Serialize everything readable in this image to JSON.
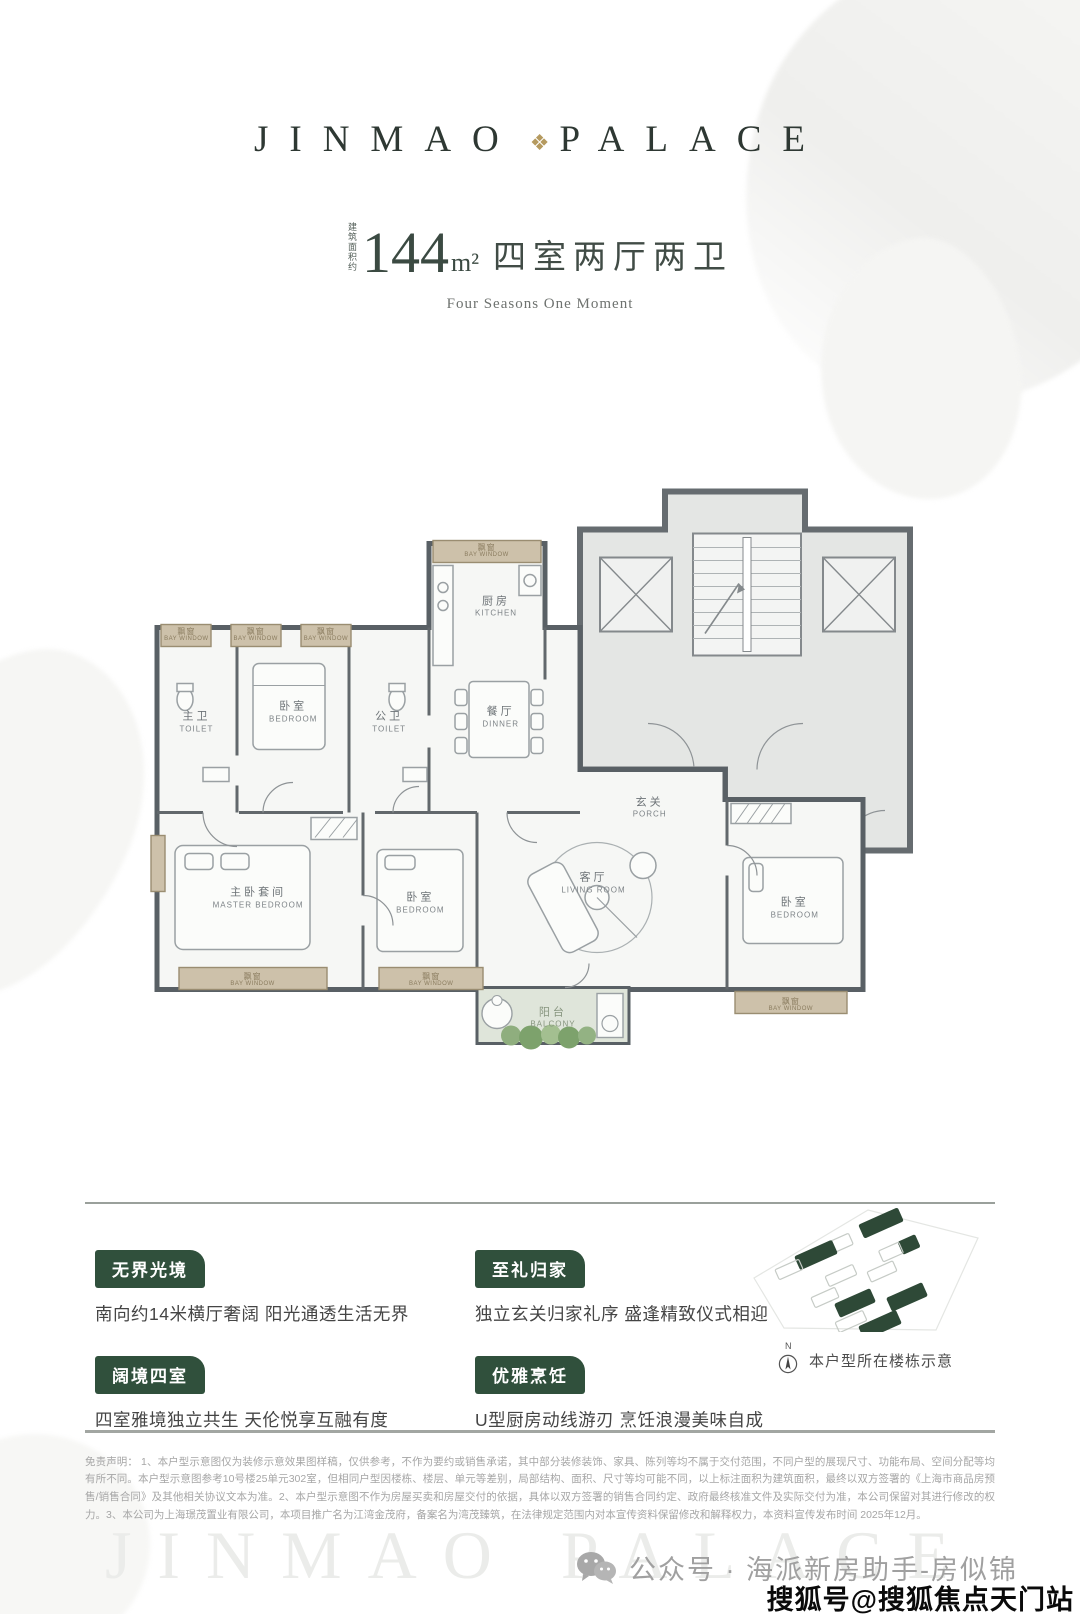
{
  "header": {
    "brand_left": "JINMAO",
    "brand_right": "PALACE",
    "emblem_glyph": "❖"
  },
  "title": {
    "area_prefix": "建筑面积约",
    "area_value": "144",
    "area_unit": "m²",
    "layout": "四室两厅两卫",
    "subtitle": "Four Seasons One Moment"
  },
  "floor_plan": {
    "rooms": [
      {
        "cn": "飘窗",
        "en": "BAY WINDOW",
        "x": 5.3,
        "y": 28.7,
        "style": "bay"
      },
      {
        "cn": "飘窗",
        "en": "BAY WINDOW",
        "x": 14.2,
        "y": 28.7,
        "style": "bay"
      },
      {
        "cn": "飘窗",
        "en": "BAY WINDOW",
        "x": 23.2,
        "y": 28.7,
        "style": "bay"
      },
      {
        "cn": "飘窗",
        "en": "BAY WINDOW",
        "x": 43.8,
        "y": 14.4,
        "style": "bay"
      },
      {
        "cn": "主卫",
        "en": "TOILET",
        "x": 6.6,
        "y": 43.6,
        "style": "room"
      },
      {
        "cn": "卧室",
        "en": "BEDROOM",
        "x": 19.0,
        "y": 41.9,
        "style": "room"
      },
      {
        "cn": "公卫",
        "en": "TOILET",
        "x": 31.3,
        "y": 43.6,
        "style": "room"
      },
      {
        "cn": "厨房",
        "en": "KITCHEN",
        "x": 45.0,
        "y": 23.9,
        "style": "room"
      },
      {
        "cn": "餐厅",
        "en": "DINNER",
        "x": 45.6,
        "y": 42.7,
        "style": "room"
      },
      {
        "cn": "玄关",
        "en": "PORCH",
        "x": 64.7,
        "y": 58.1,
        "style": "room"
      },
      {
        "cn": "主卧套间",
        "en": "MASTER BEDROOM",
        "x": 14.5,
        "y": 73.5,
        "style": "room"
      },
      {
        "cn": "卧室",
        "en": "BEDROOM",
        "x": 35.3,
        "y": 74.4,
        "style": "room"
      },
      {
        "cn": "客厅",
        "en": "LIVING ROOM",
        "x": 57.5,
        "y": 71.0,
        "style": "room"
      },
      {
        "cn": "卧室",
        "en": "BEDROOM",
        "x": 83.3,
        "y": 75.2,
        "style": "room"
      },
      {
        "cn": "飘窗",
        "en": "BAY WINDOW",
        "x": 13.8,
        "y": 87.4,
        "style": "bay"
      },
      {
        "cn": "飘窗",
        "en": "BAY WINDOW",
        "x": 36.7,
        "y": 87.4,
        "style": "bay"
      },
      {
        "cn": "飘窗",
        "en": "BAY WINDOW",
        "x": 82.8,
        "y": 91.6,
        "style": "bay"
      },
      {
        "cn": "阳台",
        "en": "BALCONY",
        "x": 52.3,
        "y": 93.8,
        "style": "balcony"
      }
    ]
  },
  "features": {
    "items": [
      {
        "tag": "无界光境",
        "desc": "南向约14米横厅奢阔 阳光通透生活无界"
      },
      {
        "tag": "至礼归家",
        "desc": "独立玄关归家礼序 盛逢精致仪式相迎"
      },
      {
        "tag": "阔境四室",
        "desc": "四室雅境独立共生 天伦悦享互融有度"
      },
      {
        "tag": "优雅烹饪",
        "desc": "U型厨房动线游刃 烹饪浪漫美味自成"
      }
    ]
  },
  "site": {
    "caption": "本户型所在楼栋示意",
    "compass_letter": "N",
    "blocks": [
      {
        "x": 120,
        "y": 12,
        "w": 42,
        "h": 14,
        "r": -24,
        "f": 1
      },
      {
        "x": 86,
        "y": 34,
        "w": 26,
        "h": 12,
        "r": -24,
        "f": 0
      },
      {
        "x": 56,
        "y": 44,
        "w": 40,
        "h": 14,
        "r": -24,
        "f": 1
      },
      {
        "x": 160,
        "y": 34,
        "w": 18,
        "h": 13,
        "r": -24,
        "f": 1
      },
      {
        "x": 140,
        "y": 42,
        "w": 22,
        "h": 12,
        "r": -24,
        "f": 0
      },
      {
        "x": 36,
        "y": 60,
        "w": 26,
        "h": 11,
        "r": -24,
        "f": 0
      },
      {
        "x": 86,
        "y": 66,
        "w": 30,
        "h": 11,
        "r": -24,
        "f": 0
      },
      {
        "x": 128,
        "y": 62,
        "w": 28,
        "h": 11,
        "r": -24,
        "f": 0
      },
      {
        "x": 72,
        "y": 88,
        "w": 26,
        "h": 11,
        "r": -24,
        "f": 0
      },
      {
        "x": 96,
        "y": 92,
        "w": 38,
        "h": 14,
        "r": -24,
        "f": 1
      },
      {
        "x": 148,
        "y": 86,
        "w": 38,
        "h": 14,
        "r": -24,
        "f": 1
      },
      {
        "x": 96,
        "y": 112,
        "w": 30,
        "h": 11,
        "r": -24,
        "f": 0
      },
      {
        "x": 120,
        "y": 114,
        "w": 40,
        "h": 14,
        "r": -24,
        "f": 1
      }
    ]
  },
  "disclaimer": {
    "text": "免责声明： 1、本户型示意图仅为装修示意效果图样稿，仅供参考，不作为要约或销售承诺，其中部分装修装饰、家具、陈列等均不属于交付范围，不同户型的展现尺寸、功能布局、空间分配等均有所不同。本户型示意图参考10号楼25单元302室，但相同户型因楼栋、楼层、单元等差别，局部结构、面积、尺寸等均可能不同，以上标注面积为建筑面积，最终以双方签署的《上海市商品房预售/销售合同》及其他相关协议文本为准。2、本户型示意图不作为房屋买卖和房屋交付的依据，具体以双方签署的销售合同约定、政府最终核准文件及实际交付为准，本公司保留对其进行修改的权力。3、本公司为上海璟茂置业有限公司，本项目推广名为江湾金茂府，备案名为湾茂臻筑，在法律规定范围内对本宣传资料保留修改和解释权力，本资料宣传发布时间 2025年12月。"
  },
  "footer": {
    "watermark": "JINMAO PALACE",
    "wechat": "公众号 · 海派新房助手-房似锦",
    "sohu": "搜狐号@搜狐焦点天门站"
  },
  "colors": {
    "accent_green": "#30503c",
    "gold": "#b59a5f",
    "wall": "#596065",
    "bay_tan": "#cdc1aa"
  }
}
